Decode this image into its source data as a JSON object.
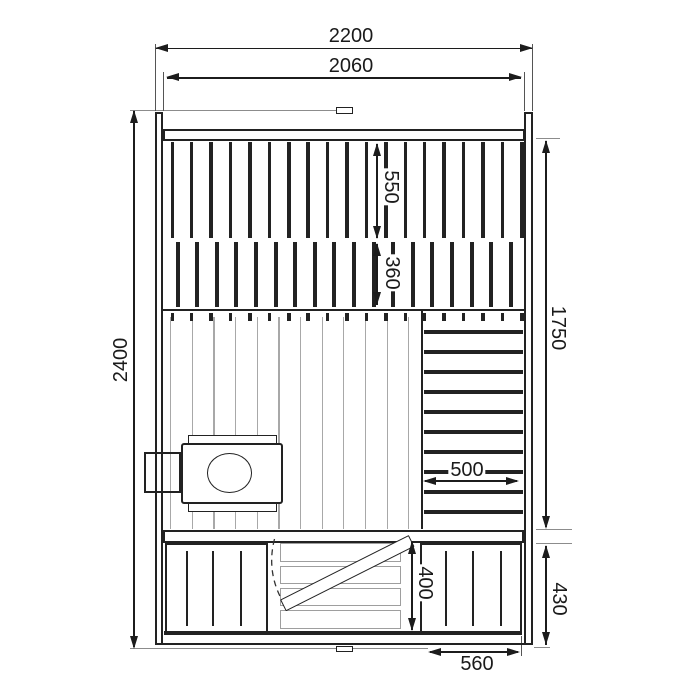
{
  "drawing": {
    "title": "sauna-front-elevation-dimension-drawing",
    "unit": "mm",
    "dimensions": {
      "overall_width": "2200",
      "inner_width": "2060",
      "overall_height": "2400",
      "interior_wall_height": "1750",
      "upper_panel_height": "550",
      "middle_panel_height": "360",
      "backrest_width": "500",
      "hatch_opening_height": "400",
      "bench_base_height": "430",
      "bench_base_width": "560"
    },
    "colors": {
      "line": "#222222",
      "dim_line": "#1c1c1c",
      "light_line": "#a8a8a8",
      "extension_line": "#8c8c8c",
      "background": "#ffffff"
    }
  }
}
